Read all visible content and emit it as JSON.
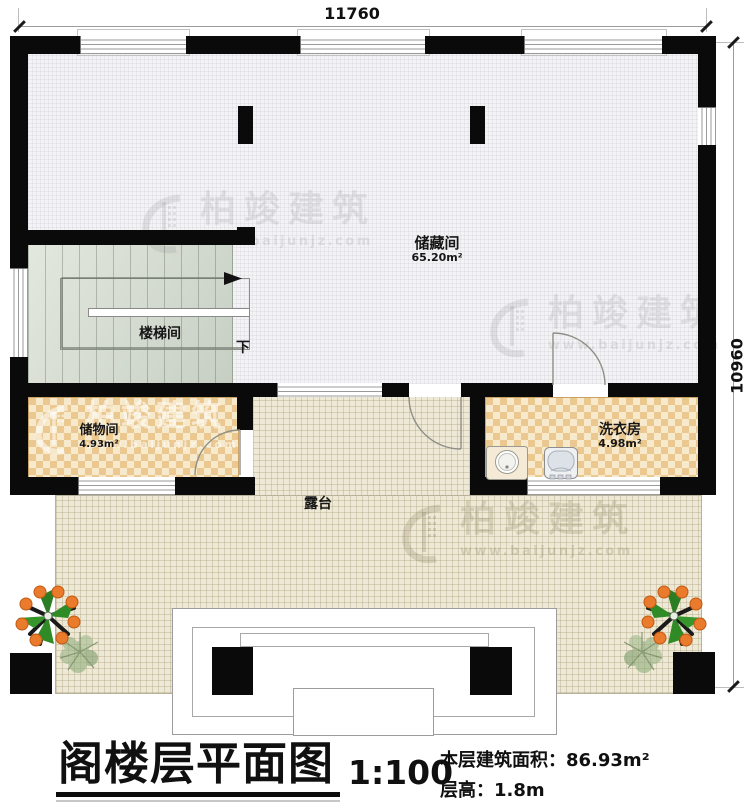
{
  "drawing": {
    "dimensions": {
      "top": "11760",
      "right": "10960"
    },
    "rooms": {
      "storage_large": {
        "name": "储藏间",
        "area": "65.20m²"
      },
      "stairwell": {
        "name": "楼梯间",
        "down": "下"
      },
      "storage_small": {
        "name": "储物间",
        "area": "4.93m²"
      },
      "laundry": {
        "name": "洗衣房",
        "area": "4.98m²"
      },
      "terrace": {
        "name": "露台"
      }
    }
  },
  "watermark": {
    "brand": "柏竣建筑",
    "url": "www.baijunjz.com"
  },
  "title_block": {
    "title": "阁楼层平面图",
    "scale": "1:100",
    "area_label": "本层建筑面积：",
    "area_value": "86.93m²",
    "floor_height_label": "层高：",
    "floor_height_value": "1.8m"
  },
  "colors": {
    "wall": "#0a0a0a",
    "checker_light": "#f7e9cb",
    "checker_dark": "#eac88f",
    "terrace_floor": "#eee9d6",
    "stair_floor": "#d6dcd2",
    "hatch_floor": "#f3f3f5"
  }
}
